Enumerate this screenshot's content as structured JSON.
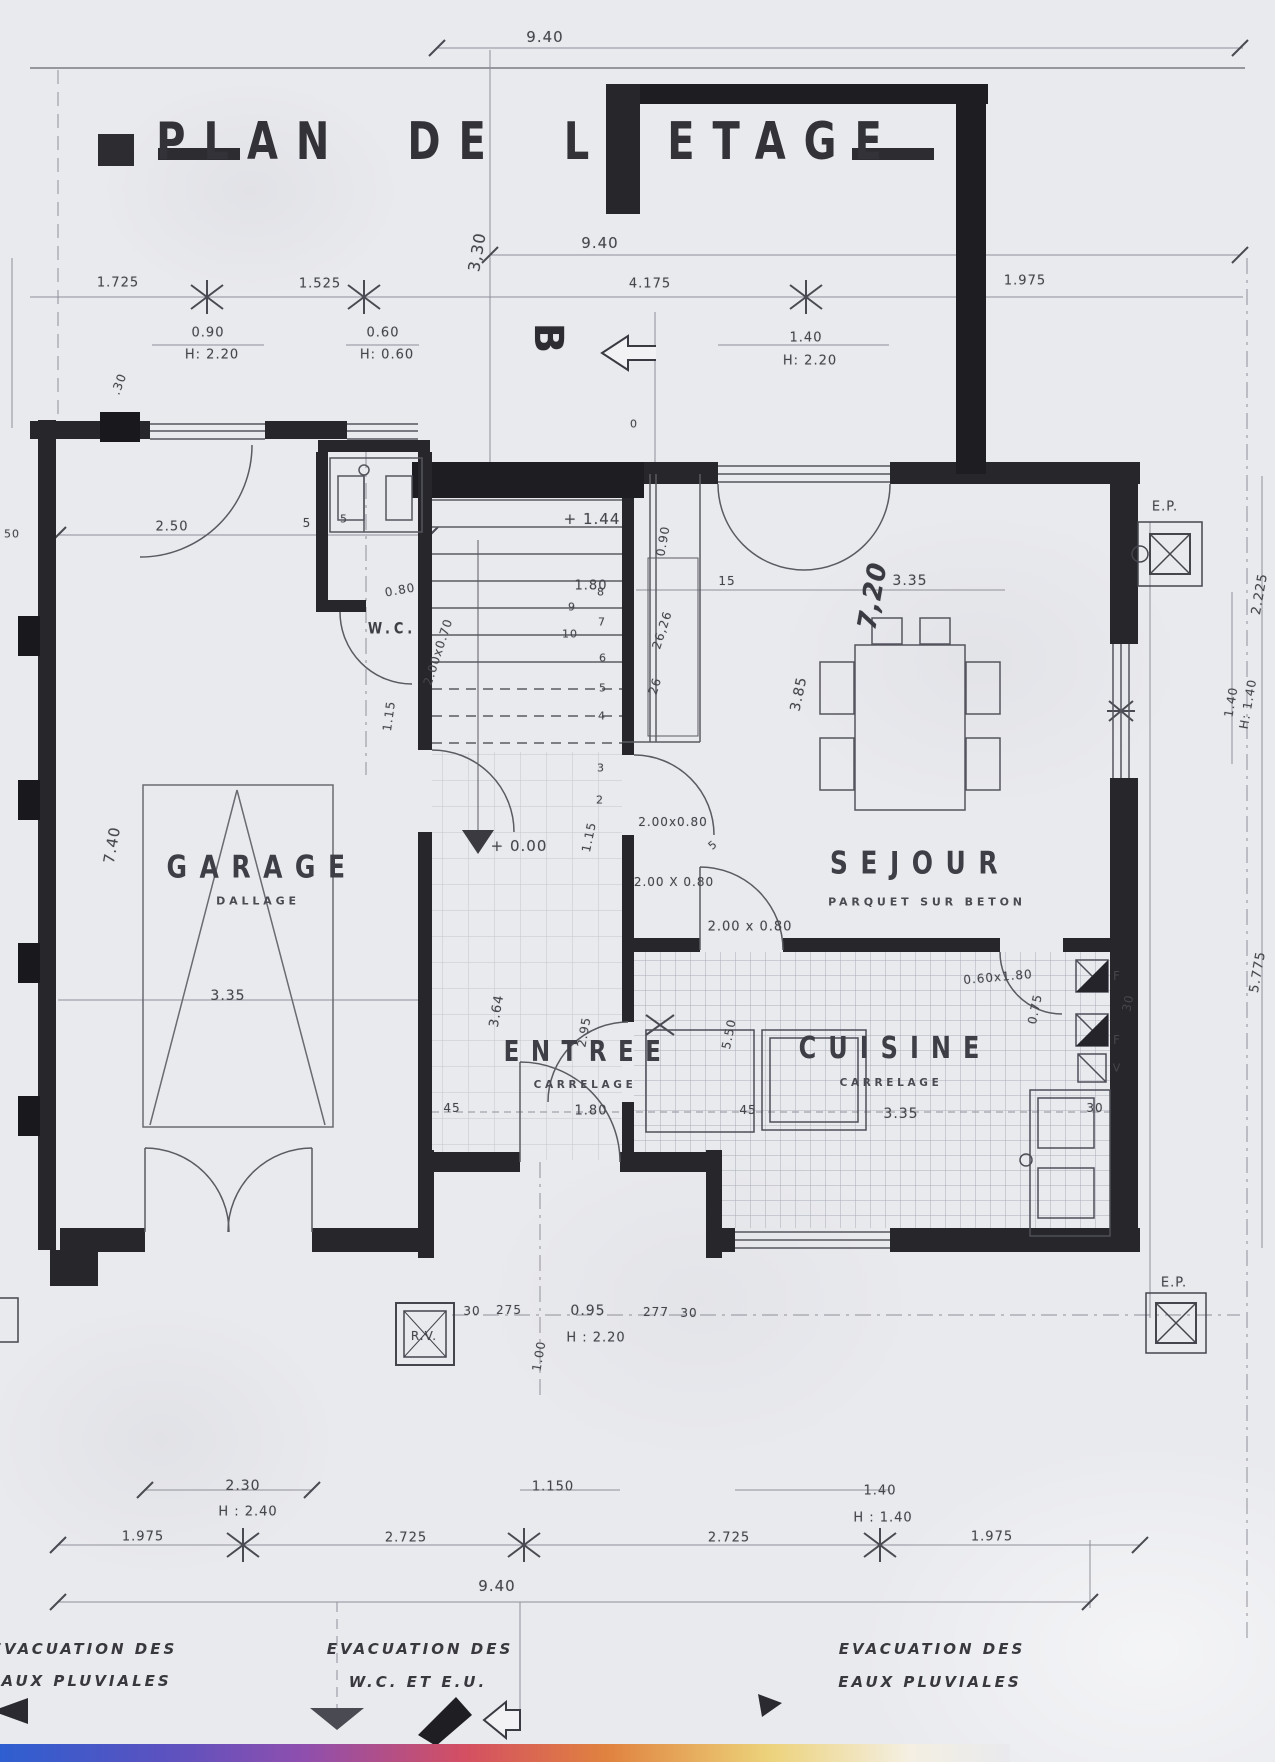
{
  "title": "PLAN DE L ETAGE",
  "rooms": {
    "garage": {
      "name": "GARAGE",
      "finish": "DALLAGE"
    },
    "wc": {
      "name": "W.C."
    },
    "entree": {
      "name": "ENTREE",
      "finish": "CARRELAGE"
    },
    "sejour": {
      "name": "SEJOUR",
      "finish": "PARQUET SUR BETON"
    },
    "cuisine": {
      "name": "CUISINE",
      "finish": "CARRELAGE"
    }
  },
  "annotations": {
    "bottom_left_1": "EVACUATION DES",
    "bottom_left_2": "EAUX PLUVIALES",
    "bottom_center_1": "EVACUATION DES",
    "bottom_center_2": "W.C.  ET  E.U.",
    "bottom_right_1": "EVACUATION DES",
    "bottom_right_2": "EAUX PLUVIALES"
  },
  "labels": [
    {
      "t": "9.40",
      "x": 545,
      "y": 37,
      "s": 15
    },
    {
      "t": "9.40",
      "x": 600,
      "y": 243,
      "s": 15
    },
    {
      "t": "3,30",
      "x": 477,
      "y": 252,
      "r": -80,
      "s": 16
    },
    {
      "t": "1.725",
      "x": 118,
      "y": 283
    },
    {
      "t": "1.525",
      "x": 320,
      "y": 284
    },
    {
      "t": "4.175",
      "x": 650,
      "y": 284
    },
    {
      "t": "1.975",
      "x": 1025,
      "y": 281
    },
    {
      "t": "0.90",
      "x": 208,
      "y": 333
    },
    {
      "t": "H: 2.20",
      "x": 212,
      "y": 355
    },
    {
      "t": "0.60",
      "x": 383,
      "y": 333
    },
    {
      "t": "H: 0.60",
      "x": 387,
      "y": 355
    },
    {
      "t": "1.40",
      "x": 806,
      "y": 338
    },
    {
      "t": "H: 2.20",
      "x": 810,
      "y": 361
    },
    {
      "t": ".30",
      "x": 119,
      "y": 384,
      "r": -70,
      "s": 12
    },
    {
      "t": "0",
      "x": 634,
      "y": 424,
      "s": 11
    },
    {
      "t": "B",
      "x": 548,
      "y": 338,
      "r": 90,
      "s": 40,
      "c": "deco",
      "n": "section-marker-b"
    },
    {
      "t": "50",
      "x": 12,
      "y": 534,
      "s": 11
    },
    {
      "t": "2.50",
      "x": 172,
      "y": 527
    },
    {
      "t": "5",
      "x": 307,
      "y": 523,
      "s": 12
    },
    {
      "t": "5",
      "x": 344,
      "y": 519,
      "s": 11
    },
    {
      "t": "7.40",
      "x": 112,
      "y": 845,
      "r": -80,
      "s": 15
    },
    {
      "t": "3.35",
      "x": 228,
      "y": 996,
      "s": 14
    },
    {
      "t": "0.80",
      "x": 400,
      "y": 590,
      "r": -10,
      "s": 12
    },
    {
      "t": "2.00x0.70",
      "x": 438,
      "y": 652,
      "r": -72,
      "s": 12
    },
    {
      "t": "1.15",
      "x": 389,
      "y": 716,
      "r": -82,
      "s": 12
    },
    {
      "t": "+ 1.44",
      "x": 592,
      "y": 519,
      "s": 15,
      "n": "level-upper"
    },
    {
      "t": "0.90",
      "x": 663,
      "y": 541,
      "r": -80,
      "s": 12
    },
    {
      "t": "1.80",
      "x": 591,
      "y": 586
    },
    {
      "t": "26,26",
      "x": 662,
      "y": 630,
      "r": -72,
      "s": 12
    },
    {
      "t": "26",
      "x": 655,
      "y": 686,
      "r": -72,
      "s": 12
    },
    {
      "t": "15",
      "x": 727,
      "y": 581,
      "s": 12
    },
    {
      "t": "8",
      "x": 601,
      "y": 592,
      "s": 11,
      "n": "stair-step-number"
    },
    {
      "t": "7",
      "x": 602,
      "y": 622,
      "s": 11,
      "n": "stair-step-number"
    },
    {
      "t": "6",
      "x": 603,
      "y": 658,
      "s": 11,
      "n": "stair-step-number"
    },
    {
      "t": "5",
      "x": 603,
      "y": 688,
      "s": 11,
      "n": "stair-step-number"
    },
    {
      "t": "4",
      "x": 602,
      "y": 716,
      "s": 11,
      "n": "stair-step-number"
    },
    {
      "t": "3",
      "x": 601,
      "y": 768,
      "s": 11,
      "n": "stair-step-number"
    },
    {
      "t": "2",
      "x": 600,
      "y": 800,
      "s": 11,
      "n": "stair-step-number"
    },
    {
      "t": "9",
      "x": 572,
      "y": 607,
      "s": 11,
      "n": "stair-step-number"
    },
    {
      "t": "10",
      "x": 570,
      "y": 634,
      "s": 11,
      "n": "stair-step-number"
    },
    {
      "t": "7,20",
      "x": 873,
      "y": 596,
      "r": -80,
      "s": 26,
      "c": "script"
    },
    {
      "t": "3.35",
      "x": 910,
      "y": 581,
      "s": 14
    },
    {
      "t": "3.85",
      "x": 799,
      "y": 694,
      "r": -78,
      "s": 14
    },
    {
      "t": "2.00 x 0.80",
      "x": 750,
      "y": 927,
      "s": 13
    },
    {
      "t": "2.00x0.80",
      "x": 673,
      "y": 822,
      "s": 12
    },
    {
      "t": "2.00 X 0.80",
      "x": 674,
      "y": 882,
      "s": 12
    },
    {
      "t": "5",
      "x": 713,
      "y": 845,
      "r": -40,
      "s": 11
    },
    {
      "t": "+ 0.00",
      "x": 519,
      "y": 846,
      "s": 15,
      "n": "level-ground"
    },
    {
      "t": "1.15",
      "x": 589,
      "y": 837,
      "r": -78,
      "s": 12
    },
    {
      "t": "3.64",
      "x": 497,
      "y": 1011,
      "r": -80,
      "s": 13
    },
    {
      "t": "2.95",
      "x": 584,
      "y": 1032,
      "r": -80,
      "s": 12
    },
    {
      "t": "1.80",
      "x": 591,
      "y": 1111
    },
    {
      "t": "45",
      "x": 452,
      "y": 1108,
      "s": 12
    },
    {
      "t": "45",
      "x": 748,
      "y": 1110,
      "s": 12
    },
    {
      "t": "3.35",
      "x": 901,
      "y": 1114,
      "s": 14
    },
    {
      "t": "5.50",
      "x": 729,
      "y": 1034,
      "r": -78,
      "s": 12
    },
    {
      "t": "0.75",
      "x": 1035,
      "y": 1009,
      "r": -78,
      "s": 12
    },
    {
      "t": "0.60x1.80",
      "x": 998,
      "y": 977,
      "r": -5,
      "s": 12
    },
    {
      "t": "F",
      "x": 1117,
      "y": 976,
      "s": 12,
      "n": "flue-marker"
    },
    {
      "t": "F",
      "x": 1117,
      "y": 1040,
      "s": 12,
      "n": "flue-marker"
    },
    {
      "t": "V",
      "x": 1117,
      "y": 1068,
      "s": 11,
      "n": "vent-marker"
    },
    {
      "t": "30",
      "x": 1095,
      "y": 1108,
      "s": 12
    },
    {
      "t": "30",
      "x": 1128,
      "y": 1003,
      "r": -78,
      "s": 12
    },
    {
      "t": "E.P.",
      "x": 1165,
      "y": 507,
      "s": 13,
      "n": "rain-outlet-label"
    },
    {
      "t": "E.P.",
      "x": 1174,
      "y": 1283,
      "s": 13,
      "n": "rain-outlet-label"
    },
    {
      "t": "2.225",
      "x": 1260,
      "y": 594,
      "r": -80,
      "s": 13
    },
    {
      "t": "1.40",
      "x": 1231,
      "y": 702,
      "r": -80,
      "s": 12
    },
    {
      "t": "H: 1.40",
      "x": 1248,
      "y": 704,
      "r": -80,
      "s": 12
    },
    {
      "t": "5.775",
      "x": 1258,
      "y": 972,
      "r": -80,
      "s": 13
    },
    {
      "t": "R.V.",
      "x": 424,
      "y": 1336,
      "s": 12,
      "n": "rv-label"
    },
    {
      "t": "30",
      "x": 472,
      "y": 1311,
      "s": 12
    },
    {
      "t": "275",
      "x": 509,
      "y": 1310,
      "s": 12
    },
    {
      "t": "0.95",
      "x": 588,
      "y": 1311,
      "s": 14
    },
    {
      "t": "H : 2.20",
      "x": 596,
      "y": 1338,
      "s": 13
    },
    {
      "t": "277",
      "x": 656,
      "y": 1312,
      "s": 12
    },
    {
      "t": "30",
      "x": 689,
      "y": 1313,
      "s": 12
    },
    {
      "t": "1.00",
      "x": 539,
      "y": 1356,
      "r": -80,
      "s": 12
    },
    {
      "t": "2.30",
      "x": 243,
      "y": 1486,
      "s": 14
    },
    {
      "t": "H : 2.40",
      "x": 248,
      "y": 1512,
      "s": 13
    },
    {
      "t": "1.150",
      "x": 553,
      "y": 1487,
      "s": 13
    },
    {
      "t": "1.40",
      "x": 880,
      "y": 1491,
      "s": 13
    },
    {
      "t": "H : 1.40",
      "x": 883,
      "y": 1518,
      "s": 13
    },
    {
      "t": "1.975",
      "x": 143,
      "y": 1537,
      "s": 13
    },
    {
      "t": "2.725",
      "x": 406,
      "y": 1538,
      "s": 13
    },
    {
      "t": "2.725",
      "x": 729,
      "y": 1538,
      "s": 13
    },
    {
      "t": "1.975",
      "x": 992,
      "y": 1537,
      "s": 13
    },
    {
      "t": "9.40",
      "x": 497,
      "y": 1586,
      "s": 15
    }
  ]
}
